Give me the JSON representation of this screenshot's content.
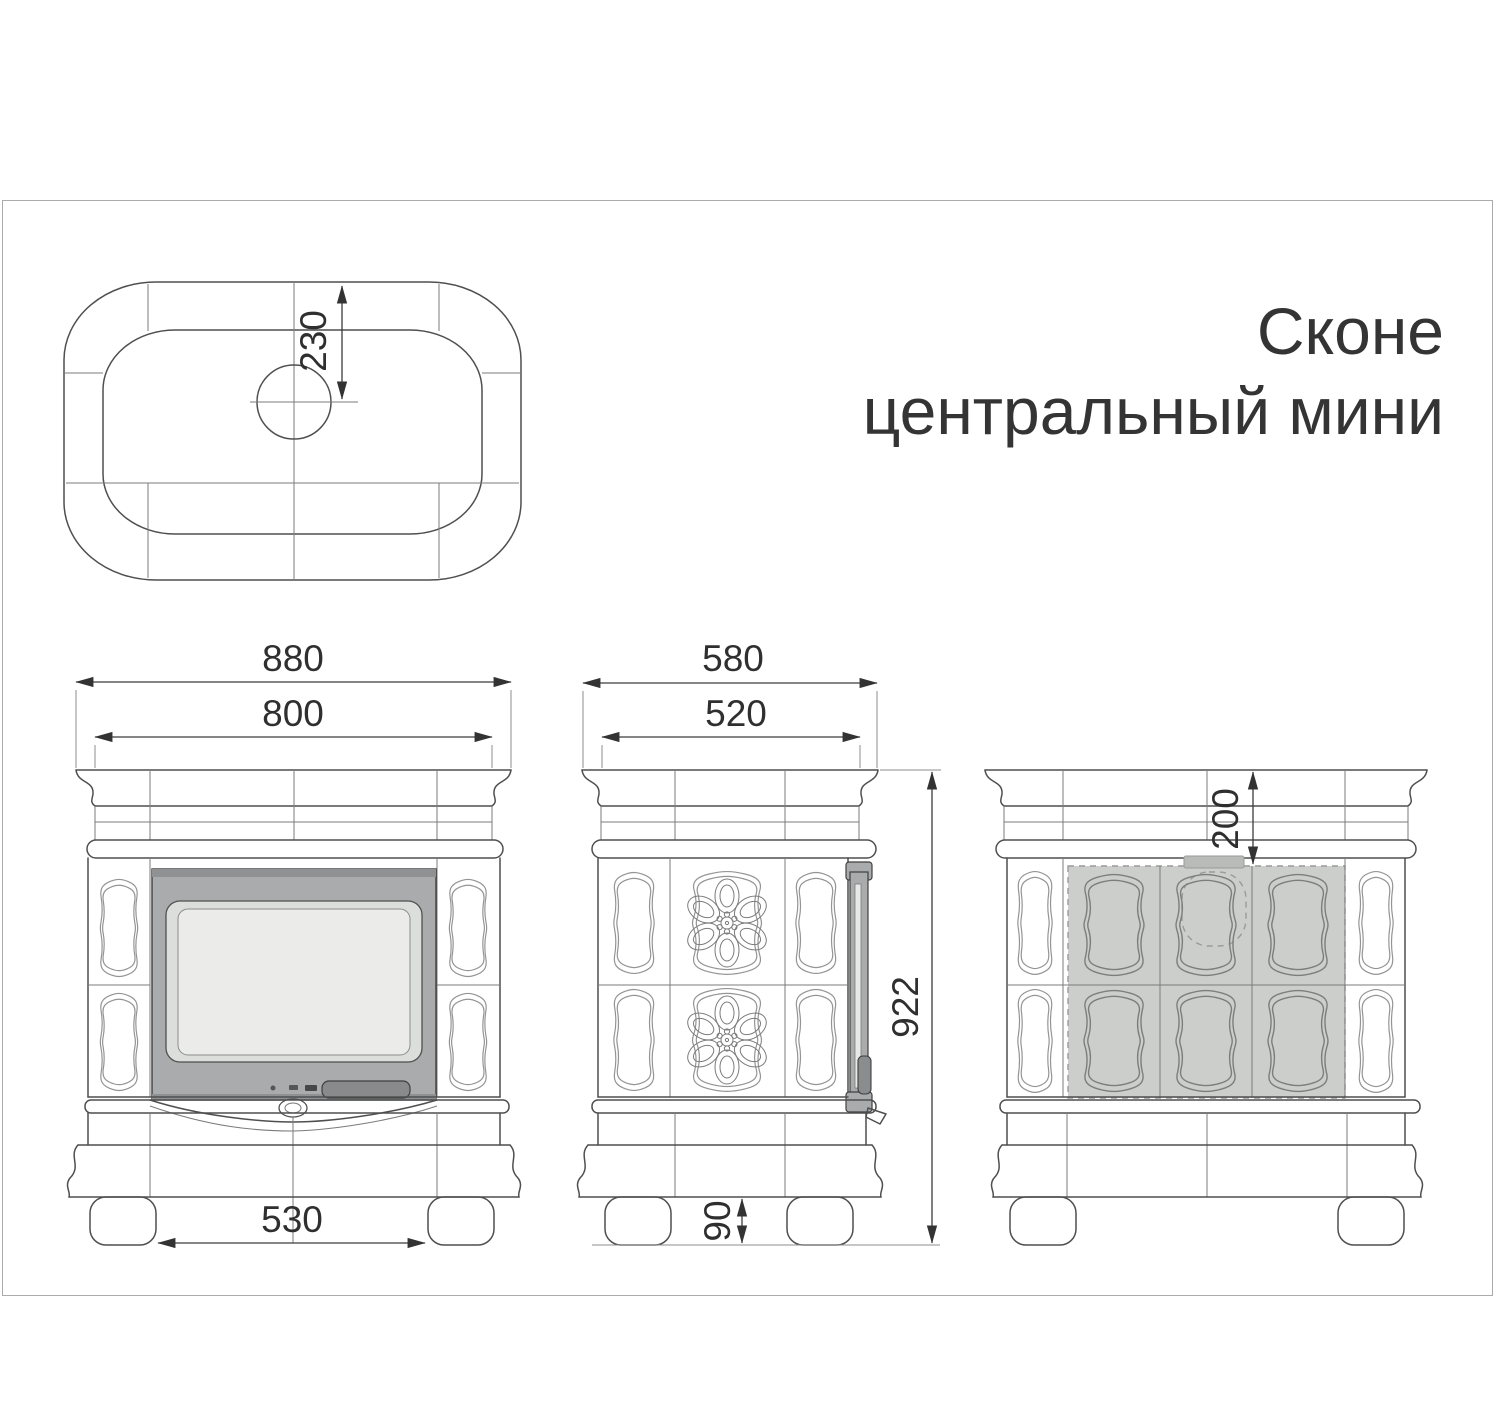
{
  "title": {
    "line1": "Сконе",
    "line2": "центральный мини"
  },
  "dimensions": {
    "top_view_flue_offset": "230",
    "front_overall_width": "880",
    "front_top_width": "800",
    "front_feet_span": "530",
    "side_overall_depth": "580",
    "side_top_depth": "520",
    "overall_height": "922",
    "foot_height": "90",
    "back_flue_drop": "200"
  },
  "colors": {
    "line": "#4f4f4f",
    "door_frame_gray": "#a9abad",
    "door_glass": "#ebece9",
    "handle_gray": "#888a8c",
    "shaded_tiles": "#cccecc",
    "sheet_border": "#ababab"
  }
}
